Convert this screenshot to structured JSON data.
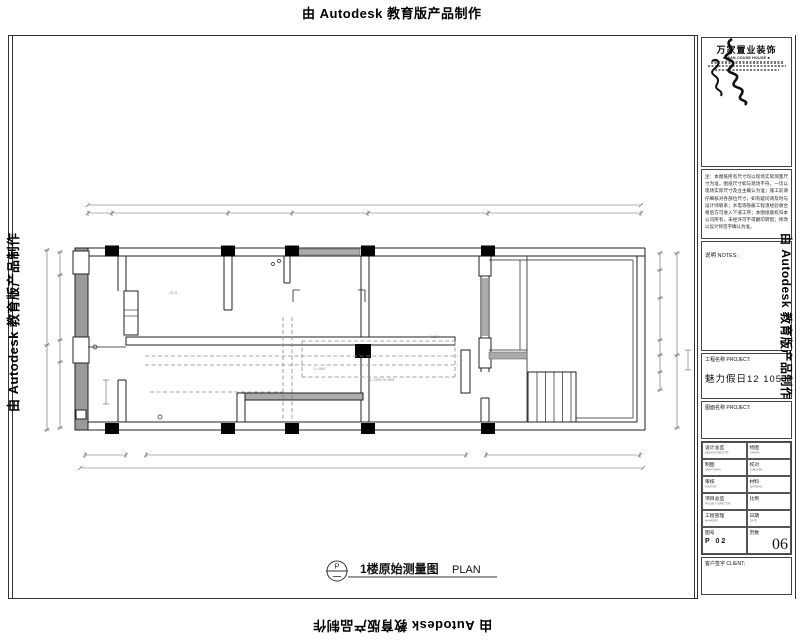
{
  "watermark": {
    "text": "由 Autodesk 教育版产品制作"
  },
  "plan": {
    "title": {
      "symbol": "P",
      "name_cn": "1楼原始测量图",
      "name_en": "PLAN"
    },
    "annotations": {
      "elevation_left": "-32.0",
      "elevation_right": "-0.15",
      "beam_label_1": "L=300",
      "beam_label_2": "L=300 H=300"
    }
  },
  "title_block": {
    "logo": {
      "company_cn": "万家置业装饰",
      "company_en": "■ WAN COUSE HOUSE ■"
    },
    "notes_paragraph": "注：本图纸所有尺寸均以现场实际测量尺寸为准，图纸尺寸如与现场不符，一切以现场实际尺寸及业主确认为准；施工前请仔细核对各部位尺寸，如有疑问请及时与设计师联系；水电等隐蔽工程须经验收合格后方可进入下道工序；本图纸版权归本公司所有，未经许可不得翻印转借；修改以设计师签字确认为准。",
    "notes_label": "说明  NOTES:",
    "project_label": "工程名称 PROJECT:",
    "project_name": "魅力假日12 105",
    "drawing_label": "图面名称 PROJECT:",
    "fields": [
      {
        "l_cn": "设计总监",
        "l_en": "DESIGN DIRECTOR",
        "r_cn": "绘图",
        "r_en": "DRAWN"
      },
      {
        "l_cn": "制图",
        "l_en": "DRAFTSMAN",
        "r_cn": "校对",
        "r_en": "CHECKER"
      },
      {
        "l_cn": "审核",
        "l_en": "AUDITOR",
        "r_cn": "材料",
        "r_en": "MATERIAL"
      },
      {
        "l_cn": "项目总监",
        "l_en": "PROJECT DIRECTOR",
        "r_cn": "比例",
        "r_en": "SCALE",
        "r_val": "1: 50"
      },
      {
        "l_cn": "工程管理",
        "l_en": "MANAGER",
        "r_cn": "日期",
        "r_en": "DATE"
      }
    ],
    "bottom": {
      "no_label": "图号",
      "no_val": "P 02",
      "page_label": "页数",
      "page_val": "06"
    },
    "client_label": "客户签字 CLIENT:"
  }
}
